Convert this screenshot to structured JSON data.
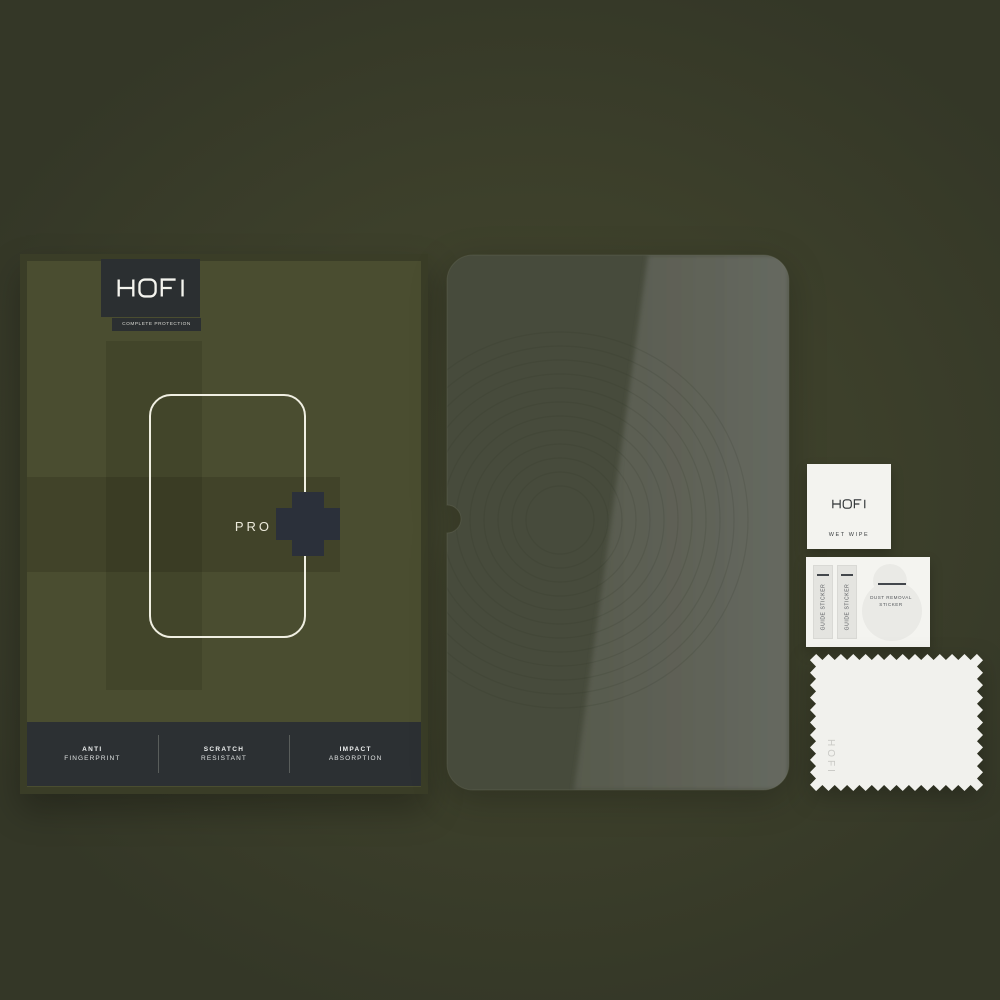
{
  "box": {
    "brand": "HOFI",
    "tagline": "COMPLETE PROTECTION",
    "product_line": "PRO",
    "plus_symbol": "+",
    "features": [
      {
        "title": "ANTI",
        "subtitle": "FINGERPRINT"
      },
      {
        "title": "SCRATCH",
        "subtitle": "RESISTANT"
      },
      {
        "title": "IMPACT",
        "subtitle": "ABSORPTION"
      }
    ]
  },
  "accessories": {
    "wet_wipe": {
      "brand": "HOFI",
      "label": "WET WIPE"
    },
    "sticker_sheet": {
      "guide_stickers": [
        "GUIDE STICKER",
        "GUIDE STICKER"
      ],
      "dust_removal_line1": "DUST REMOVAL",
      "dust_removal_line2": "STICKER"
    },
    "cloth": {
      "brand": "HOFI"
    }
  },
  "colors": {
    "background": "#3d402b",
    "box_base": "#4a4d30",
    "box_border": "#3a3d27",
    "dark_panel": "#2b2f31",
    "bottom_bar": "#2c3033",
    "plus_symbol": "#2b303a",
    "glass_left": "#474b3c",
    "glass_sheen": "#606353",
    "paper_white": "#f3f3ef"
  }
}
